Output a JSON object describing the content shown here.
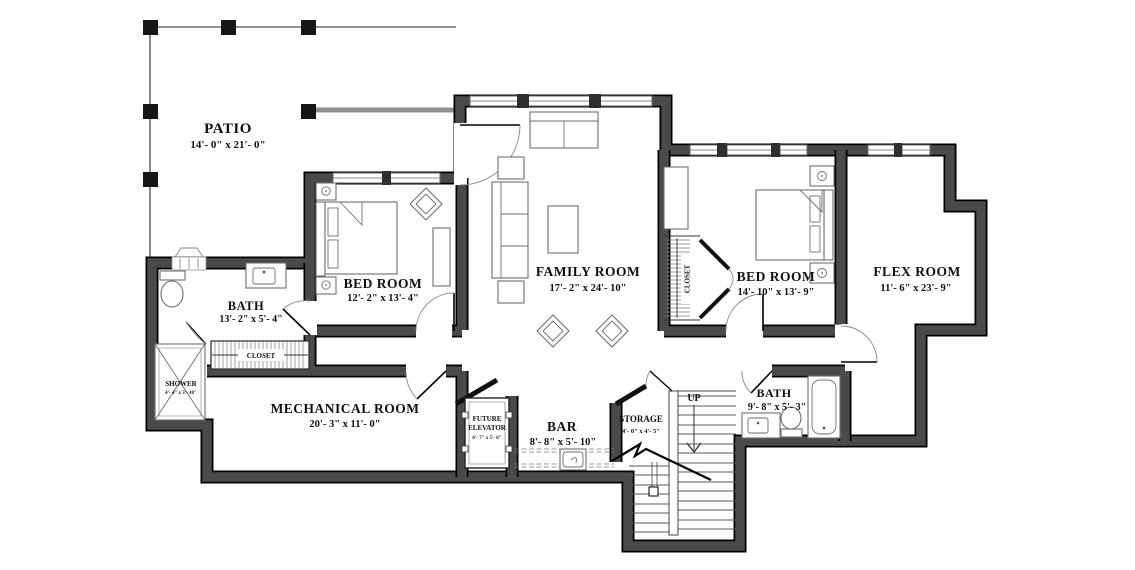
{
  "plan": {
    "type": "basement-floor-plan",
    "colors": {
      "wall_fill": "#4a4a4a",
      "wall_outline": "#000000",
      "furniture_line": "#6e6e6e",
      "background": "#ffffff",
      "text": "#101010"
    },
    "rooms": {
      "patio": {
        "name": "PATIO",
        "dims": "14'- 0\" x  21'- 0\""
      },
      "bedroom_left": {
        "name": "BED ROOM",
        "dims": "12'- 2\" x  13'- 4\""
      },
      "bath_left": {
        "name": "BATH",
        "dims": "13'- 2\" x  5'- 4\""
      },
      "shower": {
        "name": "SHOWER",
        "dims": "4'- 4\" x 3'- 10\""
      },
      "closet_left": {
        "name": "CLOSET"
      },
      "family_room": {
        "name": "FAMILY ROOM",
        "dims": "17'- 2\" x  24'- 10\""
      },
      "bedroom_right": {
        "name": "BED ROOM",
        "dims": "14'- 10\" x  13'- 9\""
      },
      "closet_right": {
        "name": "CLOSET"
      },
      "flex_room": {
        "name": "FLEX ROOM",
        "dims": "11'- 6\" x  23'- 9\""
      },
      "mechanical": {
        "name": "MECHANICAL ROOM",
        "dims": "20'- 3\" x  11'- 0\""
      },
      "elevator": {
        "line1": "FUTURE",
        "line2": "ELEVATOR",
        "dims": "6'- 7\" x 5'- 6\""
      },
      "bar": {
        "name": "BAR",
        "dims": "8'- 8\" x  5'- 10\""
      },
      "storage": {
        "name": "STORAGE",
        "dims": "4'- 0\" x  4'- 5\""
      },
      "bath_right": {
        "name": "BATH",
        "dims": "9'- 8\" x  5'- 3\""
      },
      "stairs": {
        "label": "UP"
      }
    }
  }
}
